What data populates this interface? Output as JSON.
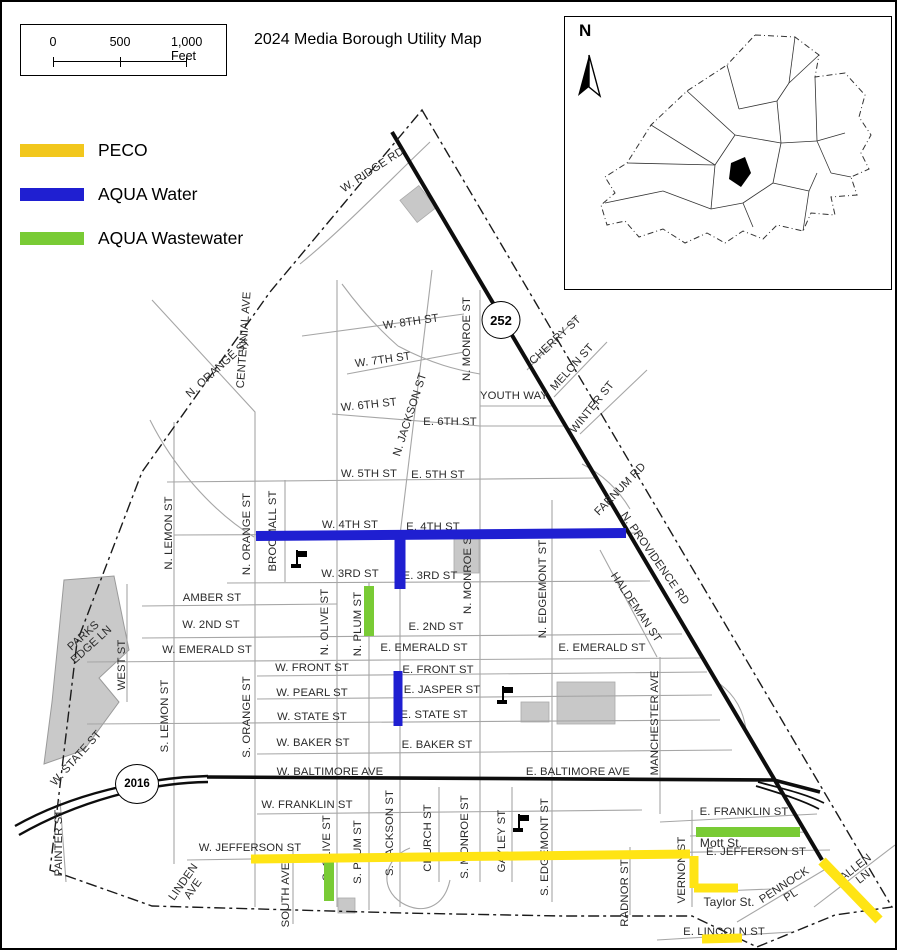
{
  "header": {
    "title": "2024 Media Borough Utility Map"
  },
  "scale_bar": {
    "labels": [
      "0",
      "500",
      "1,000 Feet"
    ]
  },
  "legend": {
    "items": [
      {
        "label": "PECO",
        "color": "#F2C71D"
      },
      {
        "label": "AQUA Water",
        "color": "#1F1FD1"
      },
      {
        "label": "AQUA Wastewater",
        "color": "#79CB35"
      }
    ]
  },
  "inset": {
    "north_label": "N"
  },
  "shields": [
    {
      "label": "252",
      "x": 499,
      "y": 318,
      "w": 37,
      "h": 36,
      "fs": 13
    },
    {
      "label": "2016",
      "x": 135,
      "y": 782,
      "w": 42,
      "h": 38,
      "fs": 11.5
    }
  ],
  "utilities": {
    "colors": {
      "PECO": "#FFE414",
      "AQUA Water": "#1F1FD1",
      "AQUA Wastewater": "#79CB35"
    },
    "lines": [
      {
        "utility": "AQUA Water",
        "x1": 254,
        "y1": 534,
        "x2": 624,
        "y2": 531,
        "w": 10
      },
      {
        "utility": "AQUA Water",
        "x1": 398,
        "y1": 533,
        "x2": 398,
        "y2": 587,
        "w": 11
      },
      {
        "utility": "AQUA Water",
        "x1": 396,
        "y1": 669,
        "x2": 396,
        "y2": 724,
        "w": 9
      },
      {
        "utility": "AQUA Wastewater",
        "x1": 367,
        "y1": 584,
        "x2": 367,
        "y2": 634,
        "w": 10
      },
      {
        "utility": "AQUA Wastewater",
        "x1": 327,
        "y1": 856,
        "x2": 327,
        "y2": 899,
        "w": 10
      },
      {
        "utility": "AQUA Wastewater",
        "x1": 694,
        "y1": 830,
        "x2": 798,
        "y2": 830,
        "w": 10
      },
      {
        "utility": "PECO",
        "x1": 249,
        "y1": 857,
        "x2": 688,
        "y2": 852,
        "w": 9
      },
      {
        "utility": "PECO",
        "x1": 692,
        "y1": 854,
        "x2": 692,
        "y2": 886,
        "w": 9
      },
      {
        "utility": "PECO",
        "x1": 692,
        "y1": 886,
        "x2": 736,
        "y2": 886,
        "w": 9
      },
      {
        "utility": "PECO",
        "x1": 700,
        "y1": 937,
        "x2": 740,
        "y2": 936,
        "w": 9
      },
      {
        "utility": "PECO",
        "x1": 820,
        "y1": 859,
        "x2": 877,
        "y2": 918,
        "w": 10
      }
    ]
  },
  "flags": [
    {
      "x": 288,
      "y": 548
    },
    {
      "x": 494,
      "y": 684
    },
    {
      "x": 510,
      "y": 812
    }
  ],
  "streets": [
    {
      "t": "W. RIDGE RD",
      "x": 371,
      "y": 169,
      "r": -33
    },
    {
      "t": "W. 8TH ST",
      "x": 409,
      "y": 321,
      "r": -8
    },
    {
      "t": "W. 7TH ST",
      "x": 381,
      "y": 359,
      "r": -8
    },
    {
      "t": "W. 6TH ST",
      "x": 367,
      "y": 404,
      "r": -6
    },
    {
      "t": "E. 6TH ST",
      "x": 448,
      "y": 421
    },
    {
      "t": "YOUTH WAY",
      "x": 512,
      "y": 395
    },
    {
      "t": "W. 5TH ST",
      "x": 367,
      "y": 473
    },
    {
      "t": "E. 5TH ST",
      "x": 436,
      "y": 474
    },
    {
      "t": "W. 4TH ST",
      "x": 348,
      "y": 524
    },
    {
      "t": "E. 4TH ST",
      "x": 431,
      "y": 526
    },
    {
      "t": "W. 3RD ST",
      "x": 348,
      "y": 573
    },
    {
      "t": "E. 3RD ST",
      "x": 428,
      "y": 575
    },
    {
      "t": "AMBER ST",
      "x": 210,
      "y": 597
    },
    {
      "t": "W. 2ND ST",
      "x": 209,
      "y": 624
    },
    {
      "t": "E. 2ND ST",
      "x": 434,
      "y": 626
    },
    {
      "t": "W. EMERALD ST",
      "x": 205,
      "y": 649
    },
    {
      "t": "E. EMERALD ST",
      "x": 422,
      "y": 647
    },
    {
      "t": "E. EMERALD ST",
      "x": 600,
      "y": 647
    },
    {
      "t": "W. FRONT ST",
      "x": 310,
      "y": 667
    },
    {
      "t": "E. FRONT ST",
      "x": 436,
      "y": 669
    },
    {
      "t": "W. PEARL ST",
      "x": 310,
      "y": 692
    },
    {
      "t": "E. JASPER ST",
      "x": 440,
      "y": 689
    },
    {
      "t": "W. STATE ST",
      "x": 310,
      "y": 716
    },
    {
      "t": "E. STATE ST",
      "x": 432,
      "y": 714
    },
    {
      "t": "W. BAKER ST",
      "x": 311,
      "y": 742
    },
    {
      "t": "E. BAKER ST",
      "x": 435,
      "y": 744
    },
    {
      "t": "W. BALTIMORE AVE",
      "x": 328,
      "y": 771
    },
    {
      "t": "E. BALTIMORE AVE",
      "x": 576,
      "y": 771
    },
    {
      "t": "W. FRANKLIN ST",
      "x": 305,
      "y": 804
    },
    {
      "t": "E. FRANKLIN ST",
      "x": 742,
      "y": 811
    },
    {
      "t": "Mott St.",
      "x": 719,
      "y": 841,
      "s": 12
    },
    {
      "t": "W. JEFFERSON ST",
      "x": 248,
      "y": 847
    },
    {
      "t": "E. JEFFERSON ST",
      "x": 754,
      "y": 851
    },
    {
      "t": "Taylor St.",
      "x": 727,
      "y": 900,
      "s": 12
    },
    {
      "t": "E. LINCOLN ST",
      "x": 722,
      "y": 931
    },
    {
      "t": "PENNOCK\nPL",
      "x": 786,
      "y": 889,
      "r": -33
    },
    {
      "t": "ALLEN LN",
      "x": 858,
      "y": 871,
      "r": -38
    },
    {
      "t": "CHERRY ST",
      "x": 554,
      "y": 339,
      "r": -43
    },
    {
      "t": "MELON ST",
      "x": 571,
      "y": 366,
      "r": -48
    },
    {
      "t": "WINTER ST",
      "x": 591,
      "y": 406,
      "r": -51
    },
    {
      "t": "FARNUM RD",
      "x": 619,
      "y": 488,
      "r": -46
    },
    {
      "t": "N. PROVIDENCE RD",
      "x": 652,
      "y": 557,
      "r": 55
    },
    {
      "t": "HALDEMAN ST",
      "x": 633,
      "y": 606,
      "r": 56
    },
    {
      "t": "CENTENNIAL AVE",
      "x": 243,
      "y": 338,
      "r": -86
    },
    {
      "t": "N. ORANGE ST",
      "x": 217,
      "y": 367,
      "r": -42
    },
    {
      "t": "N. LEMON ST",
      "x": 168,
      "y": 531,
      "r": -90
    },
    {
      "t": "N. ORANGE ST",
      "x": 246,
      "y": 532,
      "r": -90
    },
    {
      "t": "BROOMALL ST",
      "x": 272,
      "y": 529,
      "r": -90
    },
    {
      "t": "N. JACKSON ST",
      "x": 409,
      "y": 413,
      "r": -72
    },
    {
      "t": "N. MONROE ST",
      "x": 466,
      "y": 337,
      "r": -90
    },
    {
      "t": "N. MONROE ST",
      "x": 467,
      "y": 570,
      "r": -90
    },
    {
      "t": "N. OLIVE ST",
      "x": 324,
      "y": 620,
      "r": -90
    },
    {
      "t": "N. PLUM ST",
      "x": 357,
      "y": 622,
      "r": -90
    },
    {
      "t": "N. EDGEMONT ST",
      "x": 542,
      "y": 587,
      "r": -90
    },
    {
      "t": "MANCHESTER AVE",
      "x": 654,
      "y": 721,
      "r": -90
    },
    {
      "t": "WEST ST",
      "x": 121,
      "y": 663,
      "r": -90
    },
    {
      "t": "S. LEMON ST",
      "x": 164,
      "y": 714,
      "r": -90
    },
    {
      "t": "S. ORANGE ST",
      "x": 246,
      "y": 715,
      "r": -90
    },
    {
      "t": "PARKS\nEDGE LN",
      "x": 86,
      "y": 639,
      "r": -42
    },
    {
      "t": "W. STATE ST",
      "x": 75,
      "y": 757,
      "r": -48
    },
    {
      "t": "PAINTER ST",
      "x": 58,
      "y": 841,
      "r": -90
    },
    {
      "t": "LINDEN\nAVE",
      "x": 187,
      "y": 884,
      "r": -55
    },
    {
      "t": "SOUTH AVE",
      "x": 285,
      "y": 893,
      "r": -90
    },
    {
      "t": "S. OLIVE ST",
      "x": 326,
      "y": 846,
      "r": -90
    },
    {
      "t": "S. PLUM ST",
      "x": 357,
      "y": 850,
      "r": -90
    },
    {
      "t": "S. JACKSON ST",
      "x": 389,
      "y": 831,
      "r": -90
    },
    {
      "t": "CHURCH ST",
      "x": 427,
      "y": 836,
      "r": -90
    },
    {
      "t": "S. MONROE ST",
      "x": 464,
      "y": 835,
      "r": -90
    },
    {
      "t": "GAYLEY ST",
      "x": 501,
      "y": 839,
      "r": -90
    },
    {
      "t": "S. EDGEMONT ST",
      "x": 544,
      "y": 845,
      "r": -90
    },
    {
      "t": "RADNOR ST",
      "x": 624,
      "y": 891,
      "r": -90
    },
    {
      "t": "VERNON ST",
      "x": 681,
      "y": 868,
      "r": -90
    }
  ],
  "legend_rows_top": [
    138,
    182,
    226
  ]
}
